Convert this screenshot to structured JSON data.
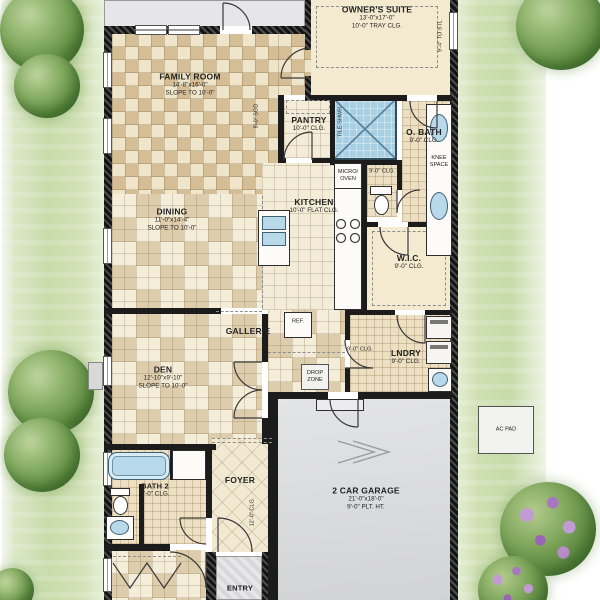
{
  "colors": {
    "wall": "#1c1c1c",
    "tile_dark": "#cdb38a",
    "tile_light": "#f3ead0",
    "patio_gray": "#e6e6e8",
    "garage_gray": "#d9dadc",
    "water_blue": "#b7d9ea",
    "lawn_green": "#c8dcaa",
    "tree_green": "#5d8a40",
    "flower_purple": "#a877c2"
  },
  "rooms": {
    "owners_suite": {
      "name": "OWNER'S SUITE",
      "dims": "13'-0\"x17'-0\"",
      "ceiling": "10'-0\" TRAY CLG."
    },
    "family_room": {
      "name": "FAMILY ROOM",
      "dims": "14'-8\"x16'-0\"",
      "ceiling": "SLOPE TO 10'-0\""
    },
    "dining": {
      "name": "DINING",
      "dims": "11'-0\"x14'-4\"",
      "ceiling": "SLOPE TO 10'-0\""
    },
    "kitchen": {
      "name": "KITCHEN",
      "ceiling": "10'-0\" FLAT CLG."
    },
    "pantry": {
      "name": "PANTRY",
      "ceiling": "10'-0\" CLG."
    },
    "owners_bath": {
      "name": "O. BATH",
      "ceiling": "9'-0\" CLG."
    },
    "water_closet": {
      "ceiling": "9'-0\" CLG."
    },
    "wic": {
      "name": "W.I.C.",
      "ceiling": "9'-0\" CLG."
    },
    "gallerie": {
      "name": "GALLERIE"
    },
    "laundry": {
      "name": "LNDRY",
      "ceiling": "9'-0\" CLG."
    },
    "hall": {
      "ceiling": "9'-0\" CLG."
    },
    "den": {
      "name": "DEN",
      "dims": "12'-10\"x9'-10\"",
      "ceiling": "SLOPE TO 10'-0\""
    },
    "garage": {
      "name": "2 CAR GARAGE",
      "dims": "21'-0\"x18'-0\"",
      "ceiling": "9'-0\" PLT. HT."
    },
    "bath2": {
      "name": "BATH 2",
      "ceiling": "9'-0\" CLG."
    },
    "foyer": {
      "name": "FOYER",
      "ceiling": "12'-0\" CLG."
    },
    "entry": {
      "name": "ENTRY"
    }
  },
  "fixtures": {
    "ref": "REF.",
    "micro_line1": "MICRO/",
    "micro_line2": "OVEN",
    "drop_line1": "DROP",
    "drop_line2": "ZONE",
    "knee_line1": "KNEE",
    "knee_line2": "SPACE",
    "tile_shower": "TILE SHWR",
    "ac_pad": "AC PAD"
  },
  "annotations": {
    "owner_window": "9'-4\" TO STL",
    "family_door": "8'-0\" SGD"
  }
}
